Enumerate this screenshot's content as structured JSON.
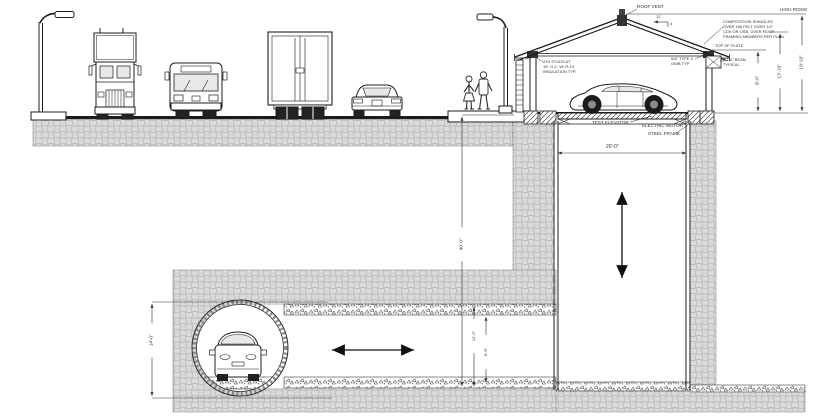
{
  "drawing": {
    "kind": "garage-elevator-and-tunnel-cross-section",
    "colors": {
      "ink": "#2a2a2a",
      "hatch": "#979797",
      "gravel": "#555555",
      "glass": "#e8e8e8",
      "paper": "#ffffff"
    }
  },
  "annotations": {
    "roof_vent": "ROOF VENT",
    "high_ridge": "HIGH RIDGE",
    "top_of_plate": "TOP OF PLATE",
    "pitch_run": "12",
    "pitch_rise": "4",
    "shingle_note": [
      "COMPOSITION SHINGLES",
      "OVER 15# FELT OVER 1/2\"",
      "CDX OR OSB, OVER ROOF",
      "FRAMING MEMBERS PER PLAN"
    ],
    "wall_note": [
      "2X4 STUDS AT",
      "16\" O.C. W/ R-13",
      "INSULATION TYP."
    ],
    "gwb_note": [
      "5/8\" TYPE X",
      "GWB TYP."
    ],
    "beam_note": [
      "1-1/2\" BEAM",
      "TYPICAL"
    ],
    "test_elevator": "TEST ELEVATOR",
    "electric_motor": "ELECTRIC MOTOR",
    "steel_frame": "STEEL FRAME"
  },
  "dimensions": {
    "shaft_width": "20'-0\"",
    "shaft_depth": "40'-0\"",
    "tunnel_diameter": "14'-0\"",
    "bore_height": "12'-2\"",
    "tunnel_clear": "8'-6\"",
    "wall_height": "8'-0\"",
    "roof_height": "13'-10\"",
    "ridge_height": "19'-10\""
  }
}
